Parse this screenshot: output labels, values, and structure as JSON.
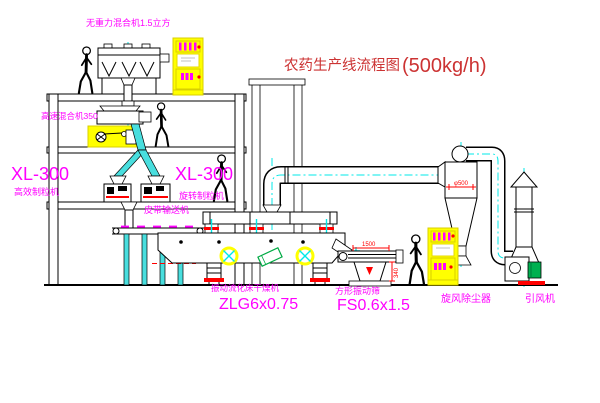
{
  "title": {
    "text": "农药生产线流程图",
    "capacity": "(500kg/h)"
  },
  "labels": {
    "gravity_mixer": "无重力混合机1.5立方",
    "high_speed_mixer": "高速混合机350",
    "granulator_left_model": "XL-300",
    "granulator_left_name": "高效制粒机",
    "granulator_right_model": "XL-300",
    "granulator_right_name": "旋转制粒机",
    "belt_conveyor": "皮带输送机",
    "dryer_name": "振动流化床干燥机",
    "dryer_model": "ZLG6x0.75",
    "sieve_name": "方形振动筛",
    "sieve_model": "FS0.6x1.5",
    "cyclone_name": "旋风除尘器",
    "fan_name": "引风机"
  },
  "dimensions": {
    "sieve_length": "1500",
    "sieve_height": "340",
    "cyclone_diameter": "φ500"
  },
  "colors": {
    "linework": "#000000",
    "centerline": "#00e8e8",
    "label_magenta": "#ff00ff",
    "accent_red": "#ff0000",
    "highlight_yellow": "#ffff00",
    "title_red": "#cc3333",
    "machine_green": "#00b050"
  }
}
